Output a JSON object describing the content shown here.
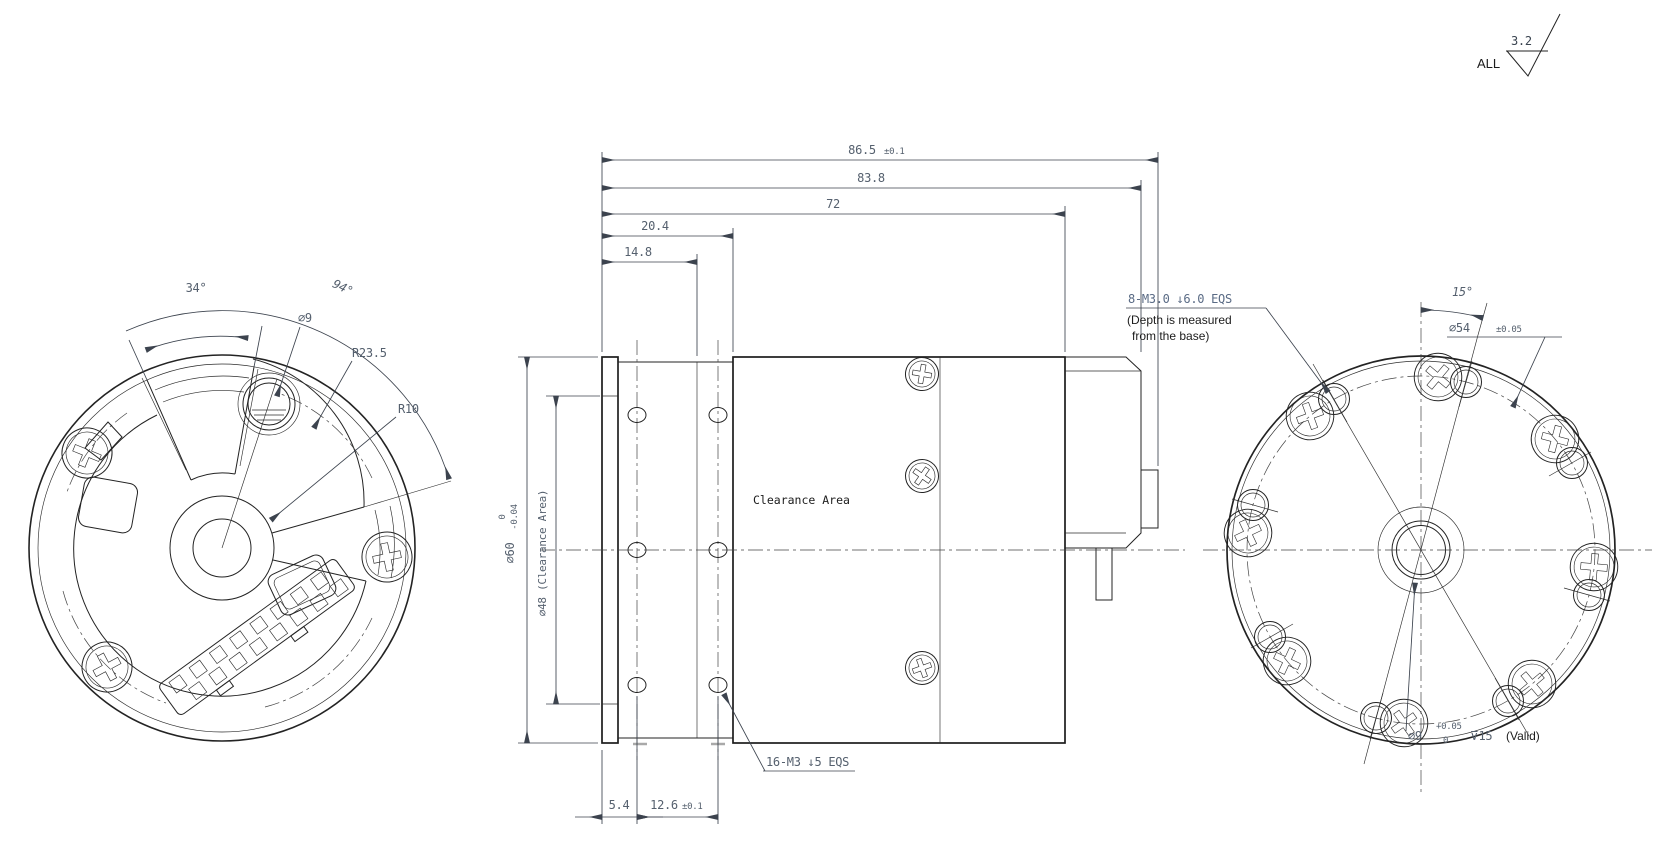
{
  "surface_finish": {
    "roughness": "3.2",
    "scope": "ALL"
  },
  "front_view": {
    "angle_sector": "34°",
    "angle_span": "94°",
    "hole_dia": "∅9",
    "radius_outer": "R23.5",
    "radius_inner": "R10"
  },
  "side_view": {
    "len_overall": "86.5",
    "len_overall_tol": "±0.1",
    "len_body": "83.8",
    "len_main": "72",
    "len_step2": "20.4",
    "len_step1": "14.8",
    "dia_body": "∅60",
    "dia_body_tol_hi": "0",
    "dia_body_tol_lo": "-0.04",
    "dia_clearance": "∅48 (Clearance Area)",
    "flange_thickness": "5.4",
    "hole_spacing": "12.6",
    "hole_spacing_tol": "±0.1",
    "clearance_label": "Clearance Area",
    "tapped_note": "16-M3 ↓5 EQS"
  },
  "rear_view": {
    "angle": "15°",
    "bolt_circle_dia": "∅54",
    "bolt_circle_tol": "±0.05",
    "tapped_note": "8-M3.0 ↓6.0 EQS",
    "depth_note_line1": "(Depth is measured",
    "depth_note_line2": "from the base)",
    "bore_dia": "∅9",
    "bore_tol_hi": "+0.05",
    "bore_tol_lo": "0",
    "bore_depth": "⊽15",
    "bore_valid": "(Valid)"
  }
}
